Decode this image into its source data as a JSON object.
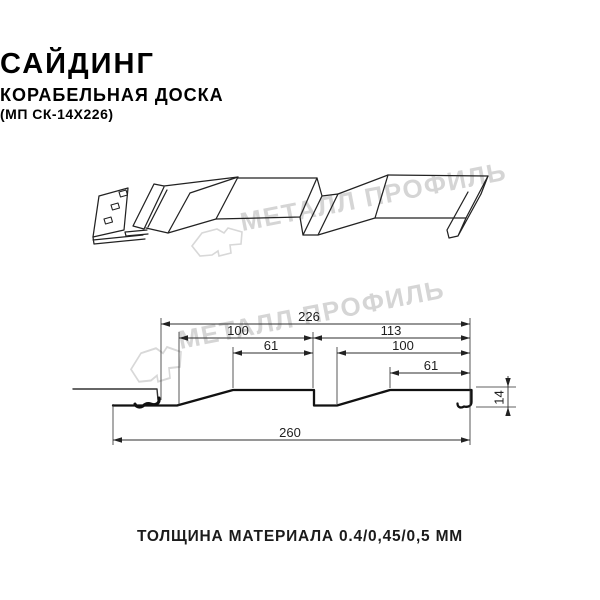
{
  "header": {
    "title": "САЙДИНГ",
    "subtitle": "КОРАБЕЛЬНАЯ ДОСКА",
    "model_code": "(МП СК-14Х226)"
  },
  "watermark": {
    "brand_text": "МЕТАЛЛ ПРОФИЛЬ",
    "color": "#d5d5d5"
  },
  "cross_section": {
    "dimensions": {
      "profile_width": "226",
      "left_board": "100",
      "right_section": "113",
      "left_flat": "61",
      "right_board": "100",
      "right_flat": "61",
      "overall_width": "260",
      "height": "14"
    }
  },
  "footer": {
    "material_thickness": "ТОЛЩИНА МАТЕРИАЛА 0.4/0,45/0,5 ММ"
  },
  "colors": {
    "line": "#1d1d1d",
    "dimension_line": "#2e2e2e",
    "watermark": "#d5d5d5",
    "background": "#ffffff"
  }
}
